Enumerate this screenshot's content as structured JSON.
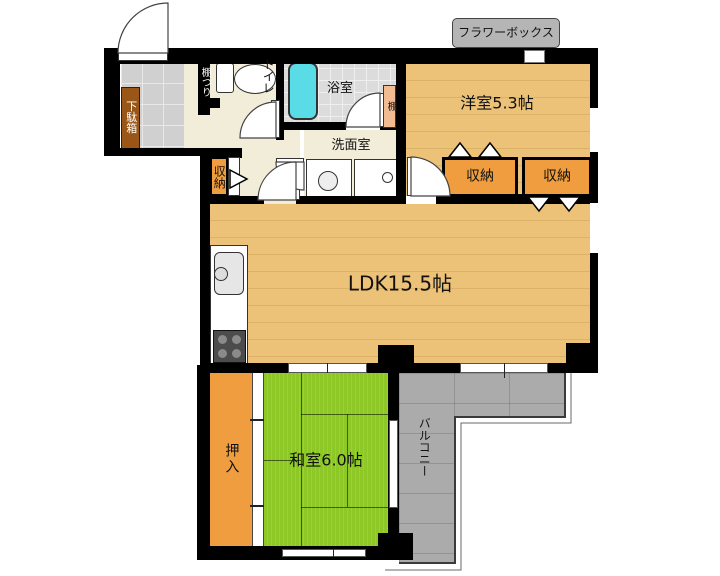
{
  "floorplan": {
    "rooms": {
      "western_room": {
        "label": "洋室5.3帖"
      },
      "ldk": {
        "label": "LDK15.5帖"
      },
      "japanese_room": {
        "label": "和室6.0帖"
      },
      "bathroom": {
        "label": "浴室"
      },
      "washroom": {
        "label": "洗面室"
      },
      "toilet": {
        "label": "トイレ"
      },
      "balcony": {
        "label": "バルコニー"
      }
    },
    "storage": {
      "closet_west_left": {
        "label": "収納"
      },
      "closet_west_right": {
        "label": "収納"
      },
      "hall_closet": {
        "label": "収納"
      },
      "oshiire": {
        "label": "押入"
      },
      "shoe_cabinet": {
        "label": "下駄箱"
      },
      "bath_shelf": {
        "label": "棚"
      },
      "toilet_shelf": {
        "label": "棚つり"
      }
    },
    "exterior": {
      "flower_box": {
        "label": "フラワーボックス"
      }
    },
    "colors": {
      "wall": "#000000",
      "wood_floor": "#ecc278",
      "hall_floor": "#f2edd9",
      "tatami_green": "#8dc826",
      "balcony_gray": "#ababab",
      "closet_orange": "#ef9d3e",
      "shoe_cabinet_brown": "#9a5617",
      "shelf_salmon": "#f3bb92",
      "bathtub_cyan": "#5adce6",
      "entry_tile_gray": "#d0d0d0",
      "bath_tile_gray": "#dcdcdc",
      "flower_box_gray": "#b5b5b5"
    }
  }
}
